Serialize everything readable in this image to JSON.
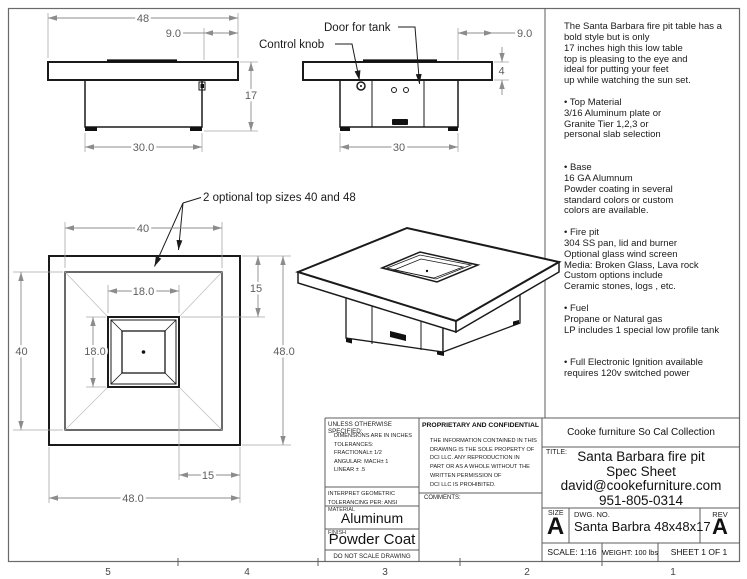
{
  "front_view": {
    "dim_width": "48",
    "dim_inset": "9.0",
    "dim_height": "17",
    "dim_base": "30.0"
  },
  "side_view": {
    "label_door": "Door for tank",
    "label_knob": "Control knob",
    "dim_overhang": "9.0",
    "dim_thickness": "4",
    "dim_base": "30"
  },
  "top_view": {
    "note": "2 optional top sizes 40 and 48",
    "dim_top_small": "40",
    "dim_opening_w": "18.0",
    "dim_left": "40",
    "dim_opening_h": "18.0",
    "dim_edge_top": "15",
    "dim_outer_h": "48.0",
    "dim_edge_bottom": "15",
    "dim_outer_w": "48.0"
  },
  "description": {
    "lines": [
      "The Santa Barbara fire pit table has a",
      "bold style but is only",
      "17 inches high this low table",
      "top is pleasing to the eye and",
      "ideal for putting your feet",
      "up while watching the sun set.",
      "",
      "• Top Material",
      "3/16 Aluminum plate or",
      "Granite Tier 1,2,3 or",
      "personal slab selection",
      "",
      "",
      "• Base",
      "16 GA Alumnum",
      "Powder coating in several",
      "standard colors or custom",
      "colors are available.",
      "",
      "• Fire pit",
      "304 SS pan, lid and burner",
      "Optional glass wind screen",
      "Media: Broken Glass, Lava rock",
      "Custom options include",
      "Ceramic stones, logs , etc.",
      "",
      "• Fuel",
      "Propane or Natural gas",
      "LP includes 1 special low profile tank",
      "",
      "",
      "•  Full Electronic Ignition available",
      "requires 120v switched power"
    ]
  },
  "title_block": {
    "tolerance_header": "UNLESS OTHERWISE SPECIFIED:",
    "tolerance_lines": [
      "DIMENSIONS ARE IN INCHES",
      "TOLERANCES:",
      "FRACTIONAL± 1/2",
      "ANGULAR: MACH± 1",
      "LINEAR   ± .5"
    ],
    "interpret_lines": [
      "INTERPRET GEOMETRIC",
      "TOLERANCING PER: ANSI"
    ],
    "material_label": "MATERIAL",
    "material_value": "Aluminum",
    "finish_label": "FINISH",
    "finish_value": "Powder Coat",
    "no_scale": "DO NOT SCALE DRAWING",
    "proprietary_header": "PROPRIETARY AND CONFIDENTIAL",
    "proprietary_lines": [
      "THE INFORMATION CONTAINED IN THIS",
      "DRAWING IS THE SOLE PROPERTY OF",
      "DCI LLC.  ANY REPRODUCTION IN",
      "PART OR AS A WHOLE WITHOUT THE",
      "WRITTEN PERMISSION OF",
      "DCI LLC IS PROHIBITED."
    ],
    "comments_label": "COMMENTS:",
    "company": "Cooke furniture So Cal Collection",
    "title_label": "TITLE:",
    "title_lines": [
      "Santa Barbara fire pit",
      "Spec Sheet",
      "david@cookefurniture.com",
      "951-805-0314"
    ],
    "size_label": "SIZE",
    "size_value": "A",
    "dwg_label": "DWG.  NO.",
    "dwg_value": "Santa Barbra 48x48x17",
    "rev_label": "REV",
    "rev_value": "A",
    "scale": "SCALE: 1:16",
    "weight": "WEIGHT: 100 lbs",
    "sheet": "SHEET 1 OF 1"
  },
  "ruler": {
    "marks": [
      "5",
      "4",
      "3",
      "2",
      "1"
    ]
  }
}
